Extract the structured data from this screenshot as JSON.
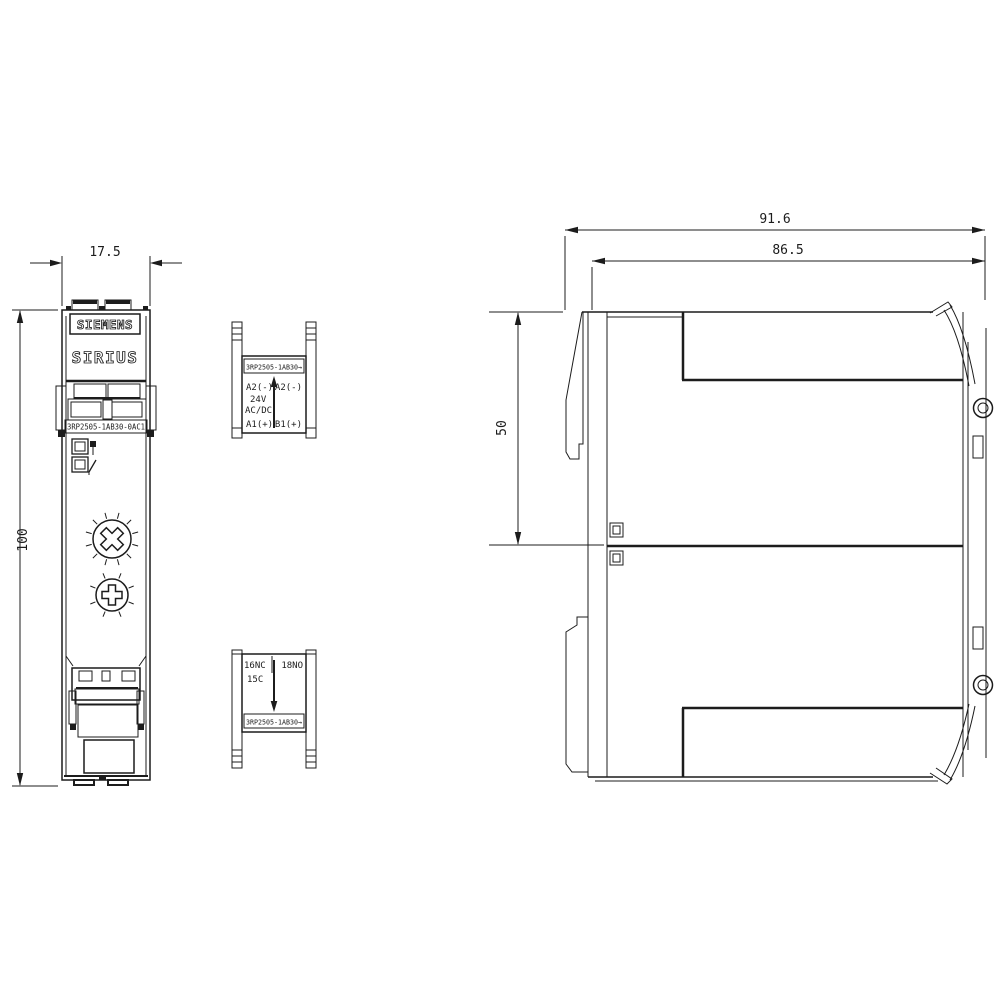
{
  "colors": {
    "line": "#1c1c1c",
    "background": "#ffffff"
  },
  "front_view": {
    "brand": "SIEMENS",
    "product_line": "SIRIUS",
    "part_number": "3RP2505-1AB30-0AC1"
  },
  "connector_top": {
    "part_number": "3RP2505-1AB30→",
    "row1_left": "A2(-)",
    "row1_right": "A2(-)",
    "row2": "24V",
    "row3": "AC/DC",
    "row4_left": "A1(+)",
    "row4_right": "B1(+)"
  },
  "connector_bottom": {
    "row1_left": "16NC",
    "row1_right": "18NO",
    "row2_left": "15C",
    "part_number": "3RP2505-1AB30→"
  },
  "dimensions": {
    "width": "17.5",
    "height": "100",
    "depth_total": "91.6",
    "depth_body": "86.5",
    "upper_height": "50"
  }
}
